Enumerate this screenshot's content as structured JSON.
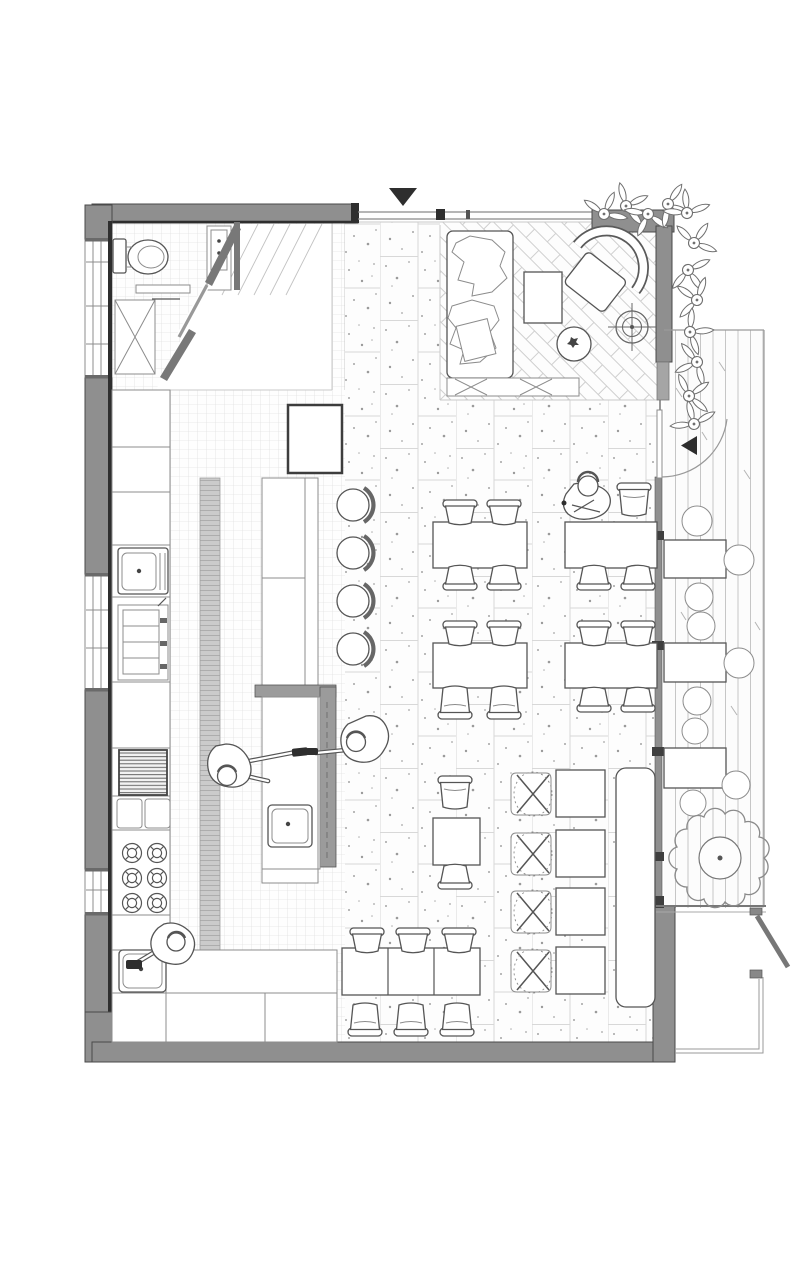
{
  "meta": {
    "title": "Cafe restaurant floor plan - top view line drawing",
    "drawing_type": "architectural floor plan",
    "has_text_labels": false
  },
  "palette": {
    "paper": "#ffffff",
    "wall": "#8f8f8f",
    "wall_edge": "#4a4a4a",
    "wall_dark": "#787878",
    "ink": "#555555",
    "ink_dark": "#2e2e2e",
    "line_light": "#c9c9c9",
    "floor_line": "#d8d8d8",
    "speckle": "#a5a5a5",
    "drain_fill": "#cbcbcb",
    "drain_line": "#adadad"
  },
  "rooms": [
    {
      "name": "wc",
      "features": [
        "toilet",
        "hand-basin",
        "shelf",
        "service-shaft",
        "diagonal-partition-with-door"
      ]
    },
    {
      "name": "kitchen",
      "features": [
        "wall-counters",
        "prep-sink",
        "prep-appliance",
        "grill-hood",
        "two-burner-modules",
        "six-burner-stove",
        "wash-sink",
        "floor-drain-channel",
        "mosaic-tile-floor"
      ]
    },
    {
      "name": "bar",
      "features": [
        "equipment-box",
        "front-counter",
        "four-bar-stools",
        "service-counter-with-sink",
        "dashed-overhang"
      ]
    },
    {
      "name": "dining",
      "features": [
        "terrazzo-tile-floor",
        "four-seat-tables",
        "two-seat-table",
        "three-table-row",
        "cross-back-chairs",
        "wall-banquette"
      ]
    },
    {
      "name": "lounge",
      "features": [
        "herringbone-floor",
        "sofa-with-cushions",
        "coffee-table",
        "fan-back-armchair",
        "round-side-table",
        "compass-target-symbol",
        "low-bench"
      ]
    },
    {
      "name": "terrace",
      "features": [
        "timber-deck",
        "outdoor-tables-with-round-chairs",
        "tree",
        "entry-door-swing",
        "rear-gate",
        "planting-border"
      ]
    }
  ],
  "counts": {
    "people": 4,
    "bar_stools": 4,
    "four_seat_tables": 4,
    "two_seat_tables": 1,
    "row_tables": 3,
    "banquette_tables": 4,
    "cross_back_chairs": 4,
    "outdoor_tables": 3,
    "stove_burners": 6
  },
  "annotations": {
    "entry_arrow": "solid triangle pointing down at top entrance",
    "door_swing_arrow": "solid triangle pointing left at terrace door"
  }
}
